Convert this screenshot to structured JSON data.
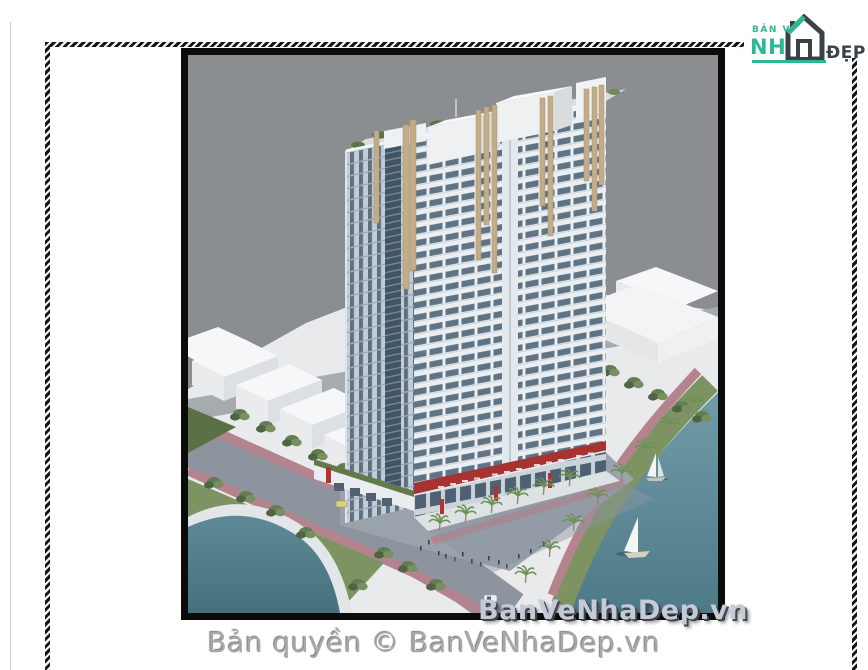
{
  "window": {
    "width": 868,
    "height": 670
  },
  "brand_logo": {
    "prefix": "BẢN VẼ",
    "word_left": "NH",
    "word_right": "ĐẸP",
    "teal": "#2cb795",
    "dark": "#3b4149"
  },
  "frame": {
    "style": "diagonal-hatch-border",
    "colors": [
      "#161616",
      "#f5f5f5"
    ]
  },
  "artwork": {
    "type": "architectural-3d-render",
    "subject": "Twin high-rise apartment towers with rooftop gardens, retail podium, lakeside promenade with palms, swimming pool and sailboats",
    "background": "#8b8e90",
    "watermark_text": "BanVeNhaDep.vn",
    "watermark_color": "#c3cbd8",
    "palette": {
      "tower_left_face": "#c2cdd8",
      "tower_right_face": "#ebeff2",
      "window_glass": "#5e7384",
      "curtain_wall": "#425466",
      "fins_tan": "#c3ac87",
      "roof_garden_green": "#5a7544",
      "penthouse_white": "#eef0f1",
      "lake_teal": "#5d8b99",
      "pool_teal": "#578694",
      "lawn_green": "#7d9362",
      "sidewalk_pink": "#b5838d",
      "street_gray": "#8d949d",
      "podium_red": "#a63232",
      "context_building_white": "#f3f4f5"
    }
  },
  "caption": {
    "text": "Bản quyền © BanVeNhaDep.vn",
    "color": "#a8a8ab"
  }
}
